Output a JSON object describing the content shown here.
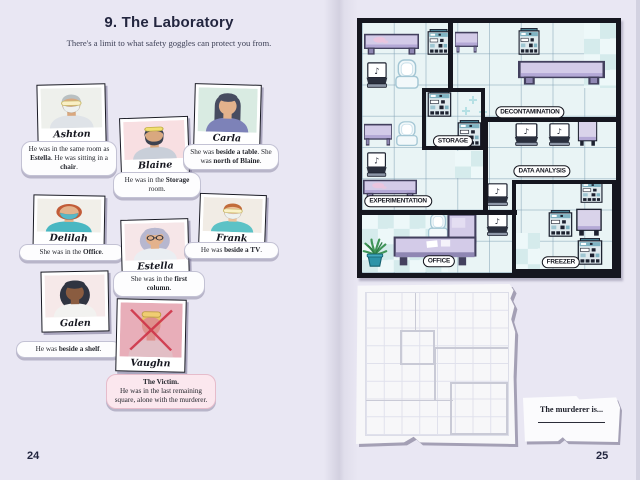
{
  "page": {
    "left_number": "24",
    "right_number": "25"
  },
  "puzzle": {
    "title": "9. The Laboratory",
    "subtitle": "There's a limit to what safety goggles can protect you from."
  },
  "suspects": [
    {
      "id": "ashton",
      "name": "Ashton",
      "clue": [
        [
          "He was in the same room as ",
          0
        ],
        [
          "Estella",
          1
        ],
        [
          ". He was sitting in a ",
          0
        ],
        [
          "chair",
          1
        ],
        [
          ".",
          0
        ]
      ],
      "portrait": {
        "bg": "#eef0ec",
        "skin": "#d9a87f",
        "hair": "#b9c0c2",
        "style": "short",
        "shirt": "#dfe3e8",
        "mask": "#eef1f0",
        "goggles": "eyes"
      }
    },
    {
      "id": "blaine",
      "name": "Blaine",
      "clue": [
        [
          "He was in the ",
          0
        ],
        [
          "Storage",
          1
        ],
        [
          " room.",
          0
        ]
      ],
      "portrait": {
        "bg": "#f8dfe2",
        "skin": "#d9a87f",
        "hair": "#3c4250",
        "style": "short",
        "beard": true,
        "shirt": "#c9cfd9",
        "goggles": "head"
      }
    },
    {
      "id": "carla",
      "name": "Carla",
      "clue": [
        [
          "She was ",
          0
        ],
        [
          "beside a table",
          1
        ],
        [
          ". She was ",
          0
        ],
        [
          "north of Blaine",
          1
        ],
        [
          ".",
          0
        ]
      ],
      "portrait": {
        "bg": "#d9ebe2",
        "skin": "#e3b28c",
        "hair": "#474c60",
        "style": "long",
        "shirt": "#7d82b8"
      }
    },
    {
      "id": "delilah",
      "name": "Delilah",
      "clue": [
        [
          "She was in the ",
          0
        ],
        [
          "Office",
          1
        ],
        [
          ".",
          0
        ]
      ],
      "portrait": {
        "bg": "#f1efe9",
        "skin": "#e3b28c",
        "hair": "#c25c38",
        "style": "bob",
        "shirt": "#49b7c2",
        "mask": "#57b8c8"
      }
    },
    {
      "id": "estella",
      "name": "Estella",
      "clue": [
        [
          "She was in the ",
          0
        ],
        [
          "first column",
          1
        ],
        [
          ".",
          0
        ]
      ],
      "portrait": {
        "bg": "#f6e6e8",
        "skin": "#e3b28c",
        "hair": "#b7b7cf",
        "style": "curly",
        "shirt": "#eaeef2",
        "glasses": true
      }
    },
    {
      "id": "frank",
      "name": "Frank",
      "clue": [
        [
          "He was ",
          0
        ],
        [
          "beside a TV",
          1
        ],
        [
          ".",
          0
        ]
      ],
      "portrait": {
        "bg": "#f1ece5",
        "skin": "#ecc29c",
        "hair": "#c26c3a",
        "style": "short",
        "shirt": "#5cc2c6",
        "mask": "#eef1ef",
        "goggles": "eyes"
      }
    },
    {
      "id": "galen",
      "name": "Galen",
      "clue": [
        [
          "He was ",
          0
        ],
        [
          "beside a shelf",
          1
        ],
        [
          ".",
          0
        ]
      ],
      "portrait": {
        "bg": "#f6e9e9",
        "skin": "#8a5c40",
        "hair": "#2f3441",
        "style": "curly",
        "shirt": "#f2f2f0"
      }
    },
    {
      "id": "vaughn",
      "name": "Vaughn",
      "clue": [
        [
          "The Victim.",
          2
        ],
        [
          "He was in the last remaining square, alone with the murderer.",
          0
        ]
      ],
      "portrait": {
        "bg": "#e9bac4",
        "skin": "#dd9890",
        "hair": "#ecd565",
        "style": "short",
        "shirt": "#e2cdd2",
        "goggles": "head",
        "crossed": true
      }
    }
  ],
  "map": {
    "labels": [
      {
        "text": "STORAGE",
        "cx": 35.8,
        "cy": 47.2
      },
      {
        "text": "DECONTAMINATION",
        "cx": 66.1,
        "cy": 35.6
      },
      {
        "text": "DATA ANALYSIS",
        "cx": 70.9,
        "cy": 59.2
      },
      {
        "text": "EXPERIMENTATION",
        "cx": 14.2,
        "cy": 71.2
      },
      {
        "text": "OFFICE",
        "cx": 30.3,
        "cy": 95.2
      },
      {
        "text": "FREEZER",
        "cx": 78.3,
        "cy": 95.6
      }
    ],
    "borders": [
      {
        "dir": "v",
        "x": 34.8,
        "y": 0,
        "len": 26.8
      },
      {
        "rect": true,
        "x": 23.6,
        "y": 26,
        "w": 24.8,
        "h": 24.8
      },
      {
        "dir": "h",
        "x": 47.6,
        "y": 38.6,
        "len": 52.4
      },
      {
        "dir": "v",
        "x": 48.6,
        "y": 38.6,
        "len": 37.2
      },
      {
        "dir": "h",
        "x": 0,
        "y": 75.8,
        "len": 61
      },
      {
        "rect": true,
        "x": 59,
        "y": 62.8,
        "w": 41,
        "h": 37.2
      }
    ],
    "items": [
      {
        "t": "table",
        "x": 0.8,
        "y": 4,
        "w": 21.7,
        "h": 8.8,
        "stain": true
      },
      {
        "t": "machine",
        "x": 25.6,
        "y": 2.4,
        "w": 9.1,
        "h": 10.4
      },
      {
        "t": "table",
        "x": 36.6,
        "y": 3.2,
        "w": 9.1,
        "h": 8.8
      },
      {
        "t": "machine",
        "x": 61.4,
        "y": 2,
        "w": 8.7,
        "h": 10.8
      },
      {
        "t": "laptop",
        "x": 1.2,
        "y": 15.6,
        "w": 9.4,
        "h": 10.8
      },
      {
        "t": "chair",
        "x": 12.6,
        "y": 14.4,
        "w": 10.2,
        "h": 12.4
      },
      {
        "t": "table",
        "x": 61.4,
        "y": 14.8,
        "w": 34.3,
        "h": 10
      },
      {
        "t": "machine",
        "x": 25.6,
        "y": 26.8,
        "w": 9.8,
        "h": 10.8
      },
      {
        "t": "machine",
        "x": 37.4,
        "y": 38.8,
        "w": 9.8,
        "h": 10.8
      },
      {
        "t": "table",
        "x": 0.8,
        "y": 40,
        "w": 11,
        "h": 9.2
      },
      {
        "t": "chair",
        "x": 13,
        "y": 39.2,
        "w": 9.4,
        "h": 10.4
      },
      {
        "t": "laptop",
        "x": 1.2,
        "y": 51.6,
        "w": 9.1,
        "h": 10.4
      },
      {
        "t": "table",
        "x": 0.4,
        "y": 62.4,
        "w": 21.3,
        "h": 8.4,
        "stain": true
      },
      {
        "t": "laptop",
        "x": 48.4,
        "y": 64,
        "w": 9.8,
        "h": 9.6
      },
      {
        "t": "laptop",
        "x": 48.4,
        "y": 76,
        "w": 9.8,
        "h": 9.6
      },
      {
        "t": "chair",
        "x": 25.6,
        "y": 76,
        "w": 8.7,
        "h": 10.8
      },
      {
        "t": "plant",
        "x": 0,
        "y": 85.6,
        "w": 10.2,
        "h": 12
      },
      {
        "t": "desk",
        "x": 12.2,
        "y": 76,
        "w": 33.1,
        "h": 21.6
      },
      {
        "t": "machine",
        "x": 85.8,
        "y": 62.8,
        "w": 9.1,
        "h": 9.2
      },
      {
        "t": "machine",
        "x": 73.2,
        "y": 74.8,
        "w": 9.8,
        "h": 10.8
      },
      {
        "t": "cabinet",
        "x": 83.9,
        "y": 74,
        "w": 11,
        "h": 11.6
      },
      {
        "t": "machine",
        "x": 84.6,
        "y": 86,
        "w": 10.2,
        "h": 10.8
      },
      {
        "t": "laptop",
        "x": 59.4,
        "y": 40,
        "w": 10.6,
        "h": 9.6
      },
      {
        "t": "laptop",
        "x": 72.8,
        "y": 40,
        "w": 9.8,
        "h": 9.6
      },
      {
        "t": "cabinet",
        "x": 84.6,
        "y": 38.8,
        "w": 8.3,
        "h": 10.8
      }
    ],
    "checkers": [
      {
        "x": 87.5,
        "y": 0,
        "w": 12.5,
        "h": 26
      },
      {
        "x": 0,
        "y": 76,
        "w": 34,
        "h": 23.5
      },
      {
        "x": 36.6,
        "y": 51,
        "w": 11.4,
        "h": 11
      },
      {
        "x": 59,
        "y": 84,
        "w": 11,
        "h": 15.5
      }
    ],
    "sparkles": [
      {
        "x": 42,
        "y": 29
      },
      {
        "x": 46,
        "y": 34
      },
      {
        "x": 39.5,
        "y": 33.5
      }
    ]
  },
  "answer_note": {
    "prompt": "The murderer is..."
  }
}
